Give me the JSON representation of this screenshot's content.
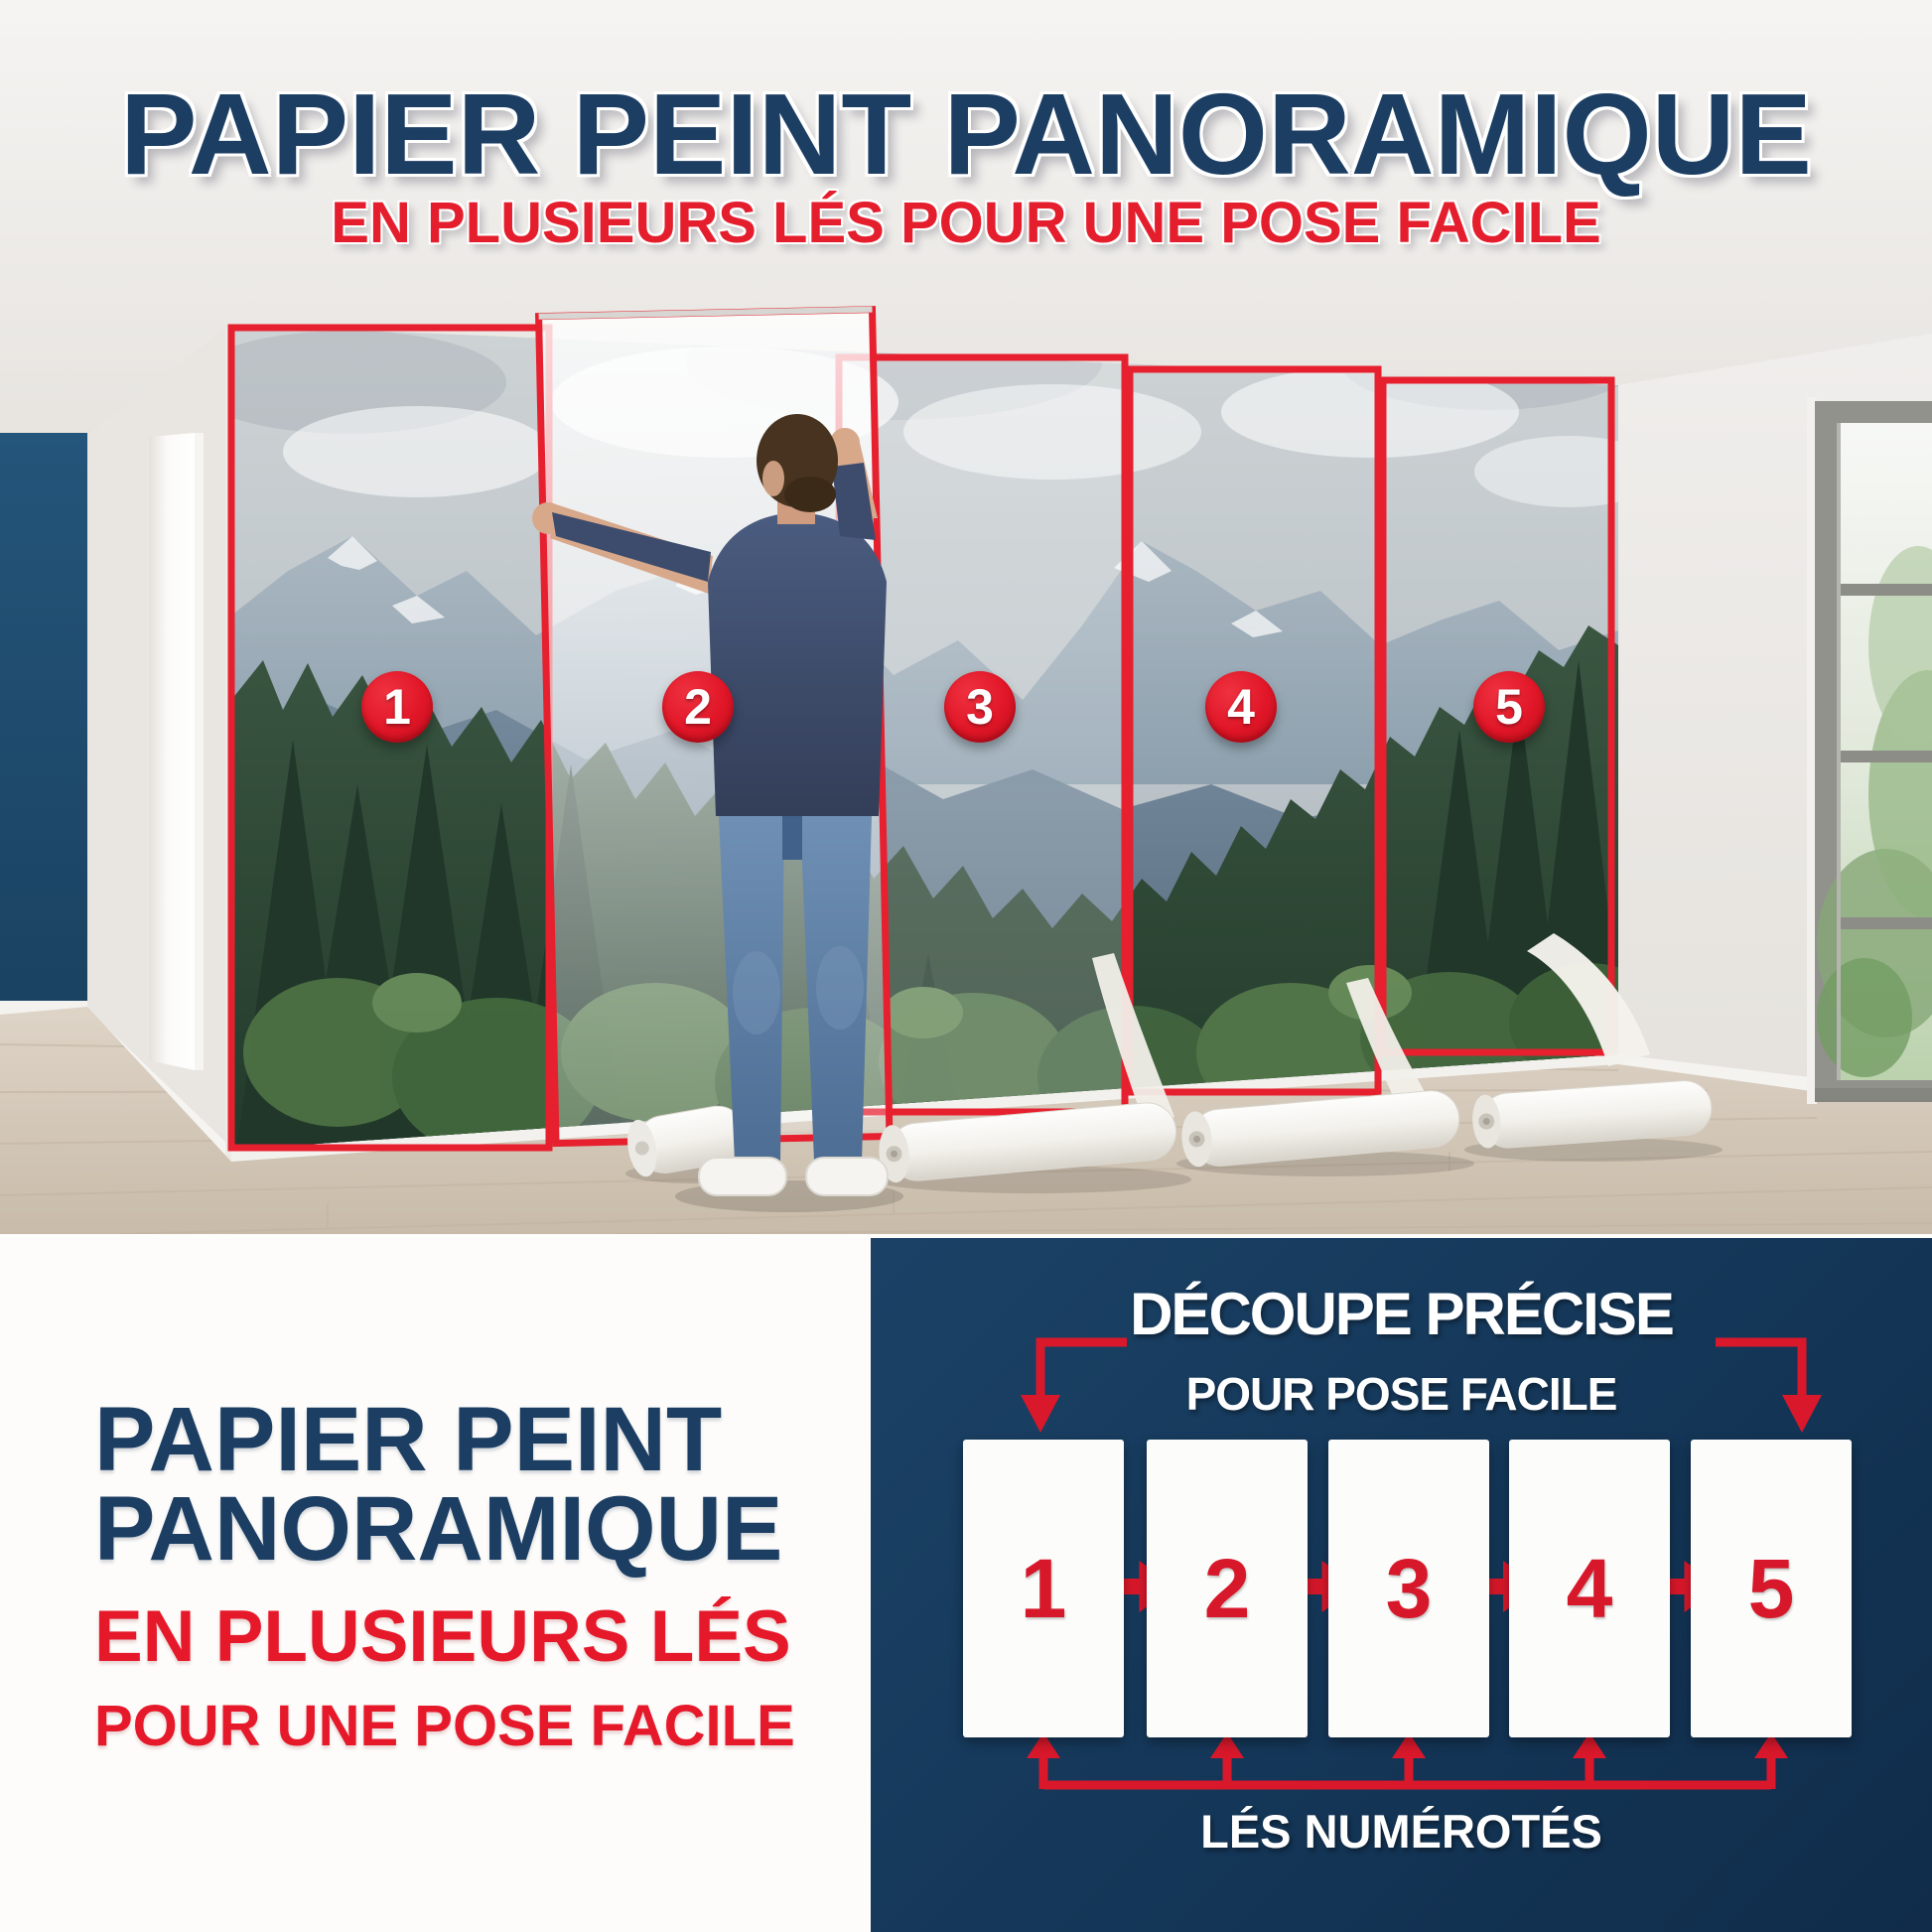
{
  "header": {
    "title": "PAPIER PEINT PANORAMIQUE",
    "subtitle": "EN PLUSIEURS LÉS POUR UNE POSE FACILE"
  },
  "photo": {
    "strip_numbers": [
      "1",
      "2",
      "3",
      "4",
      "5"
    ]
  },
  "bottom_left": {
    "title_line1": "PAPIER PEINT",
    "title_line2": "PANORAMIQUE",
    "subtitle_line1": "EN PLUSIEURS LÉS",
    "subtitle_line2": "POUR UNE POSE FACILE"
  },
  "diagram": {
    "title_line1": "DÉCOUPE PRÉCISE",
    "title_line2": "POUR POSE FACILE",
    "panel_numbers": [
      "1",
      "2",
      "3",
      "4",
      "5"
    ],
    "caption": "LÉS NUMÉROTÉS"
  },
  "colors": {
    "navy_text": "#1c3e63",
    "red_accent": "#e6202e",
    "diagram_background": "#15385a"
  }
}
